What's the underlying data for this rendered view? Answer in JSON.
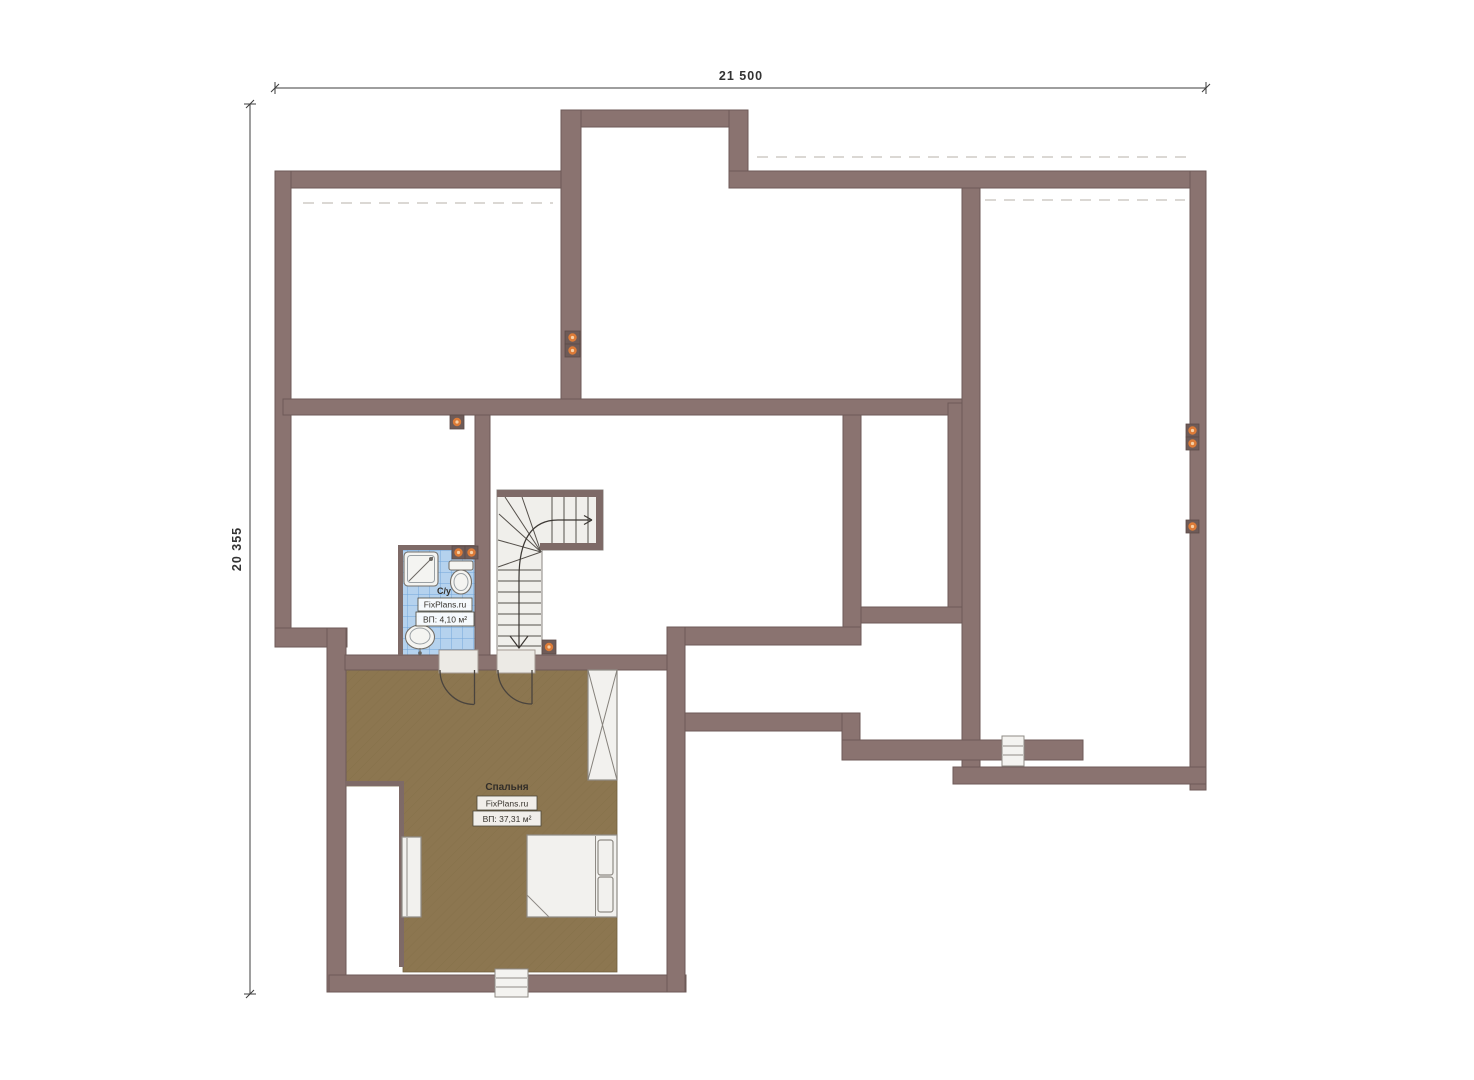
{
  "page": {
    "type": "architectural-floor-plan",
    "background": "#ffffff"
  },
  "dimensions": {
    "width_label": "21 500",
    "height_label": "20 355"
  },
  "rooms": {
    "bathroom": {
      "name": "С/у",
      "brand": "FixPlans.ru",
      "area": "ВП: 4,10 м²"
    },
    "bedroom": {
      "name": "Спальня",
      "brand": "FixPlans.ru",
      "area": "ВП: 37,31 м²"
    }
  },
  "colors": {
    "wall": "#8a7370",
    "wall_outline": "#6d5a57",
    "bedroom_floor": "#8c7650",
    "bathroom_tile": "#b5d2ee",
    "tile_grid": "#74a6da",
    "stairs": "#f0efeb",
    "furniture": "#f2f1ee",
    "socket_accent": "#dc7b38",
    "dimension_text": "#333333"
  },
  "icons": {
    "socket": "power-socket-icon",
    "shower": "shower-icon",
    "toilet": "toilet-icon",
    "sink": "sink-icon",
    "bed": "bed-icon",
    "wardrobe": "wardrobe-icon",
    "dresser": "dresser-icon",
    "stairs": "staircase-icon",
    "window": "window-icon",
    "door": "door-arc-icon"
  }
}
